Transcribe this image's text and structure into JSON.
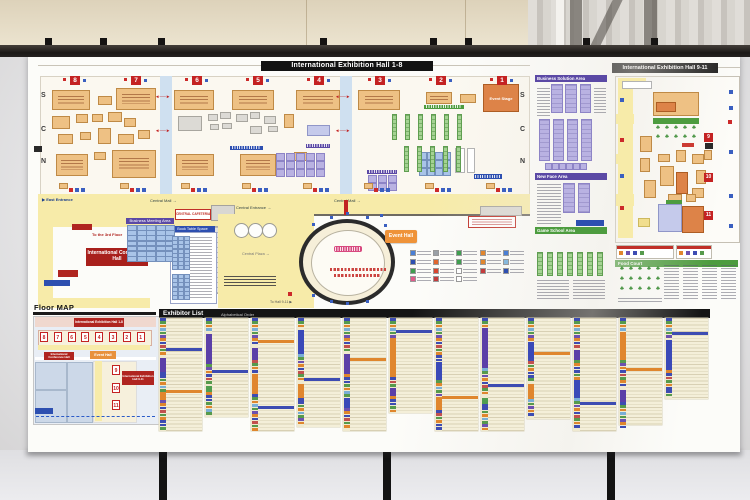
{
  "scene": {
    "wall_color": "#ddd2ba",
    "rail_color": "#1b1816",
    "poster_color": "#fcfcf9",
    "accent_red": "#c42222",
    "accent_yellow": "#f7eba9",
    "accent_green": "#4d9c3f",
    "accent_purple": "#5b49a5",
    "accent_blue": "#2d4fb0"
  },
  "poster": {
    "hall18": {
      "title": "International Exhibition Hall 1-8",
      "halls": [
        "8",
        "7",
        "6",
        "5",
        "4",
        "3",
        "2",
        "1"
      ],
      "hall_centers": [
        47,
        108,
        169,
        230,
        291,
        352,
        413,
        474
      ],
      "rows": [
        "S",
        "C",
        "N"
      ],
      "row_ys": [
        38,
        72,
        104
      ],
      "labels": {
        "east_entrance": "▶ East Entrance",
        "central_mall": "Central Mall →",
        "central_entrance": "Central Entrance →",
        "event_stage": "Event Stage"
      },
      "corridors": [
        [
          132,
          22,
          12,
          118
        ],
        [
          312,
          22,
          12,
          118
        ]
      ],
      "arrows": [
        [
          127,
          40
        ],
        [
          127,
          74
        ],
        [
          307,
          40
        ],
        [
          307,
          74
        ]
      ],
      "booths": [
        [
          24,
          36,
          38,
          20,
          "t"
        ],
        [
          70,
          42,
          14,
          9,
          "t"
        ],
        [
          88,
          34,
          40,
          22,
          "t"
        ],
        [
          146,
          36,
          40,
          20,
          "t"
        ],
        [
          204,
          36,
          42,
          20,
          "t"
        ],
        [
          268,
          36,
          44,
          20,
          "t"
        ],
        [
          330,
          36,
          42,
          20,
          "t"
        ],
        [
          398,
          38,
          26,
          12,
          "t"
        ],
        [
          432,
          40,
          16,
          9,
          "t"
        ],
        [
          455,
          30,
          36,
          28,
          "O"
        ],
        [
          24,
          62,
          18,
          13,
          "t"
        ],
        [
          48,
          60,
          12,
          9,
          "t"
        ],
        [
          64,
          60,
          11,
          8,
          "t"
        ],
        [
          80,
          58,
          14,
          10,
          "t"
        ],
        [
          96,
          64,
          12,
          9,
          "t"
        ],
        [
          30,
          80,
          15,
          10,
          "t"
        ],
        [
          52,
          78,
          11,
          8,
          "t"
        ],
        [
          70,
          74,
          13,
          16,
          "t"
        ],
        [
          90,
          80,
          16,
          10,
          "t"
        ],
        [
          110,
          76,
          12,
          9,
          "t"
        ],
        [
          150,
          62,
          24,
          15,
          "g"
        ],
        [
          180,
          60,
          10,
          7,
          "g"
        ],
        [
          192,
          58,
          11,
          7,
          "g"
        ],
        [
          182,
          70,
          9,
          6,
          "g"
        ],
        [
          194,
          69,
          10,
          6,
          "g"
        ],
        [
          208,
          60,
          12,
          8,
          "g"
        ],
        [
          222,
          58,
          10,
          7,
          "g"
        ],
        [
          236,
          62,
          12,
          8,
          "g"
        ],
        [
          222,
          72,
          12,
          8,
          "g"
        ],
        [
          240,
          72,
          10,
          6,
          "g"
        ],
        [
          256,
          60,
          10,
          14,
          "t"
        ],
        [
          279,
          71,
          23,
          11,
          "l"
        ],
        [
          28,
          100,
          32,
          22,
          "t"
        ],
        [
          66,
          98,
          12,
          8,
          "t"
        ],
        [
          84,
          96,
          44,
          28,
          "t"
        ],
        [
          148,
          100,
          38,
          22,
          "t"
        ],
        [
          212,
          100,
          36,
          22,
          "t"
        ],
        [
          266,
          98,
          13,
          9,
          "t"
        ],
        [
          427,
          94,
          10,
          25,
          "w"
        ],
        [
          439,
          94,
          8,
          25,
          "w"
        ]
      ],
      "area_bars": [
        [
          278,
          90,
          24,
          4,
          "ph"
        ],
        [
          202,
          92,
          33,
          4,
          "bh"
        ],
        [
          339,
          116,
          30,
          4,
          "ph"
        ],
        [
          396,
          51,
          40,
          4,
          "gh"
        ],
        [
          446,
          120,
          28,
          5,
          "bh"
        ]
      ],
      "grids": [
        {
          "x": 249,
          "y": 100,
          "cols": 5,
          "rows": 3,
          "cw": 7,
          "ch": 6,
          "gx": 3,
          "gy": 2,
          "c": "cellp"
        },
        {
          "x": 341,
          "y": 122,
          "cols": 3,
          "rows": 2,
          "cw": 7,
          "ch": 6,
          "gx": 3,
          "gy": 2,
          "c": "cellp"
        },
        {
          "x": 392,
          "y": 99,
          "cols": 4,
          "rows": 3,
          "cw": 6,
          "ch": 6,
          "gx": 2,
          "gy": 2,
          "c": "cellb"
        }
      ],
      "green_strips": [
        {
          "x": 364,
          "y": 60,
          "n": 6,
          "step": 13,
          "w": 5,
          "h": 26
        },
        {
          "x": 376,
          "y": 92,
          "n": 5,
          "step": 13,
          "w": 5,
          "h": 26
        }
      ]
    },
    "wing": {
      "conference_hall": "International Conference Hall",
      "to_3rd_floor": "To the 3rd Floor",
      "meeting_area": "Business Meeting Area",
      "book_table": "Book Table Space",
      "cafeteria": "CENTRAL CAFETERIA",
      "central_plaza": "Central Plaza →",
      "event_hall": "Event Hall",
      "to_hall911": "To Hall 9-11 ▶",
      "oval_dots": [
        [
          284,
          169
        ],
        [
          302,
          162
        ],
        [
          338,
          162
        ],
        [
          356,
          170
        ],
        [
          284,
          240
        ],
        [
          302,
          246
        ],
        [
          338,
          246
        ],
        [
          318,
          158
        ],
        [
          318,
          248
        ],
        [
          352,
          160
        ]
      ]
    },
    "legend": {
      "items": [
        "#4a7fd4",
        "#9aa0a6",
        "#3f9e4f",
        "#e0862e",
        "#4a7fd4",
        "#2d4fb0",
        "#e0662e",
        "#3f9e4f",
        "#e0862e",
        "#86b8dc",
        "#3f9e4f",
        "#d8452e",
        "#ffffff",
        "#c43c3c",
        "#2d4fb0",
        "#e05a8a",
        "#c43c3c",
        "#ffffff"
      ]
    },
    "mid": {
      "sections": [
        {
          "label": "Business Solution Area",
          "cls": "ph",
          "y": 21
        },
        {
          "label": "New Face Area",
          "cls": "ph",
          "y": 119
        },
        {
          "label": "Game School Area",
          "cls": "gh",
          "y": 173
        }
      ],
      "purple_strips": [
        [
          524,
          31,
          10,
          27
        ],
        [
          538,
          31,
          10,
          27
        ],
        [
          553,
          31,
          9,
          27
        ],
        [
          512,
          66,
          9,
          40
        ],
        [
          526,
          66,
          9,
          40
        ],
        [
          540,
          66,
          9,
          40
        ],
        [
          554,
          66,
          9,
          40
        ],
        [
          536,
          130,
          10,
          28
        ],
        [
          551,
          130,
          10,
          28
        ]
      ],
      "cells_row": {
        "x": 518,
        "y": 110,
        "n": 6,
        "w": 5,
        "h": 5,
        "gap": 2
      },
      "text_blocks": [
        [
          509,
          130,
          24,
          42
        ],
        [
          509,
          226,
          32,
          20
        ],
        [
          545,
          226,
          32,
          20
        ],
        [
          509,
          34,
          13,
          30
        ],
        [
          566,
          34,
          12,
          26
        ]
      ],
      "blue_bar": [
        548,
        166,
        28,
        6
      ],
      "green_strips": {
        "x": 509,
        "y": 198,
        "n": 7,
        "step": 10,
        "w": 6,
        "h": 24
      }
    },
    "hall911": {
      "title": "International Exhibition Hall 9-11",
      "halls": [
        "9",
        "10",
        "11"
      ],
      "hall_ys": [
        79,
        119,
        157
      ],
      "food_court": "Food Court",
      "yellow": [
        [
          590,
          26,
          15,
          158
        ],
        [
          590,
          24,
          28,
          8
        ],
        [
          588,
          60,
          18,
          10
        ],
        [
          588,
          100,
          16,
          10
        ],
        [
          588,
          140,
          18,
          12
        ]
      ],
      "booths": [
        [
          594,
          27,
          30,
          8,
          "w"
        ],
        [
          625,
          38,
          46,
          24,
          "t"
        ],
        [
          628,
          48,
          20,
          10,
          "O"
        ],
        [
          625,
          64,
          46,
          6,
          "gh"
        ],
        [
          612,
          82,
          12,
          16,
          "t"
        ],
        [
          612,
          104,
          10,
          14,
          "t"
        ],
        [
          616,
          126,
          12,
          18,
          "t"
        ],
        [
          630,
          100,
          12,
          8,
          "t"
        ],
        [
          632,
          112,
          14,
          20,
          "t"
        ],
        [
          648,
          96,
          10,
          12,
          "t"
        ],
        [
          648,
          118,
          12,
          22,
          "O"
        ],
        [
          664,
          100,
          12,
          10,
          "t"
        ],
        [
          668,
          116,
          10,
          14,
          "t"
        ],
        [
          676,
          96,
          8,
          10,
          "t"
        ],
        [
          664,
          134,
          12,
          10,
          "t"
        ],
        [
          640,
          140,
          14,
          8,
          "t"
        ],
        [
          658,
          140,
          10,
          8,
          "t"
        ],
        [
          610,
          164,
          12,
          9,
          "by"
        ],
        [
          654,
          89,
          12,
          4,
          "br"
        ],
        [
          677,
          89,
          8,
          6,
          "bk"
        ],
        [
          638,
          146,
          16,
          5,
          "gh"
        ],
        [
          630,
          150,
          24,
          28,
          "l"
        ],
        [
          654,
          152,
          22,
          27,
          "O"
        ]
      ],
      "trees_top": {
        "x": 628,
        "y": 71,
        "cols": 5,
        "rows": 2,
        "sx": 9,
        "sy": 9
      },
      "trees_bottom": {
        "x": 592,
        "y": 212,
        "cols": 5,
        "rows": 3,
        "sx": 9,
        "sy": 10
      },
      "dots": [
        [
          701,
          36,
          "b"
        ],
        [
          701,
          52,
          "b"
        ],
        [
          700,
          66,
          "r"
        ],
        [
          701,
          96,
          "b"
        ],
        [
          701,
          140,
          "b"
        ],
        [
          701,
          170,
          "b"
        ],
        [
          592,
          44,
          "b"
        ],
        [
          592,
          84,
          "r"
        ],
        [
          592,
          120,
          "b"
        ],
        [
          592,
          152,
          "r"
        ]
      ],
      "legend_boxes": [
        [
          588,
          191,
          56,
          12
        ],
        [
          648,
          191,
          34,
          12
        ]
      ],
      "text_cols": [
        [
          636,
          211,
          15,
          36
        ],
        [
          655,
          211,
          15,
          36
        ],
        [
          674,
          211,
          15,
          36
        ],
        [
          693,
          211,
          15,
          36
        ],
        [
          590,
          244,
          44,
          5
        ]
      ]
    },
    "floor_map": {
      "title": "Floor MAP",
      "hall18_label": "International Exhibition Hall 1-8",
      "hall911_label": "International Exhibition Hall 9-11",
      "conference_label": "International Conference Hall",
      "event_label": "Event Hall",
      "halls18": [
        "8",
        "7",
        "6",
        "5",
        "4",
        "3",
        "2",
        "1"
      ],
      "halls911": [
        "9",
        "10",
        "11"
      ]
    },
    "exhibitors": {
      "title": "Exhibitor List",
      "subtitle": "Alphabetical Order",
      "columns": [
        {
          "h": 113,
          "runs": "m40 P14 m20 O8 m31",
          "bars": [
            [
              30,
              "#3d4cb2"
            ],
            [
              72,
              "#df862d"
            ]
          ]
        },
        {
          "h": 99,
          "runs": "m16 P30 m22 G6 m25",
          "bars": [
            [
              52,
              "#3d4cb2"
            ]
          ]
        },
        {
          "h": 113,
          "runs": "m30 P12 m14 O20 m37",
          "bars": [
            [
              22,
              "#df862d"
            ],
            [
              88,
              "#3d4cb2"
            ]
          ]
        },
        {
          "h": 109,
          "runs": "m12 B24 m30 O14 m29",
          "bars": [
            [
              60,
              "#3d4cb2"
            ]
          ]
        },
        {
          "h": 113,
          "runs": "m36 P20 m24 B10 m23",
          "bars": [
            [
              40,
              "#df862d"
            ]
          ]
        },
        {
          "h": 95,
          "runs": "m20 O36 m14 P8 m17",
          "bars": [
            [
              12,
              "#3d4cb2"
            ]
          ]
        },
        {
          "h": 113,
          "runs": "m44 B18 m20 O10 m21",
          "bars": [
            [
              78,
              "#df862d"
            ]
          ]
        },
        {
          "h": 113,
          "runs": "m10 P40 m30 G6 m27",
          "bars": [
            [
              66,
              "#3d4cb2"
            ]
          ]
        },
        {
          "h": 101,
          "runs": "m24 B16 m26 O12 m23",
          "bars": [
            [
              34,
              "#df862d"
            ]
          ]
        },
        {
          "h": 113,
          "runs": "m32 P10 m20 B18 m33",
          "bars": [
            [
              84,
              "#3d4cb2"
            ]
          ]
        },
        {
          "h": 107,
          "runs": "m14 O28 m30 P12 m29",
          "bars": [
            [
              50,
              "#df862d"
            ]
          ]
        },
        {
          "h": 81,
          "runs": "m22 B30 m29",
          "bars": [
            [
              14,
              "#3d4cb2"
            ]
          ]
        }
      ]
    }
  }
}
